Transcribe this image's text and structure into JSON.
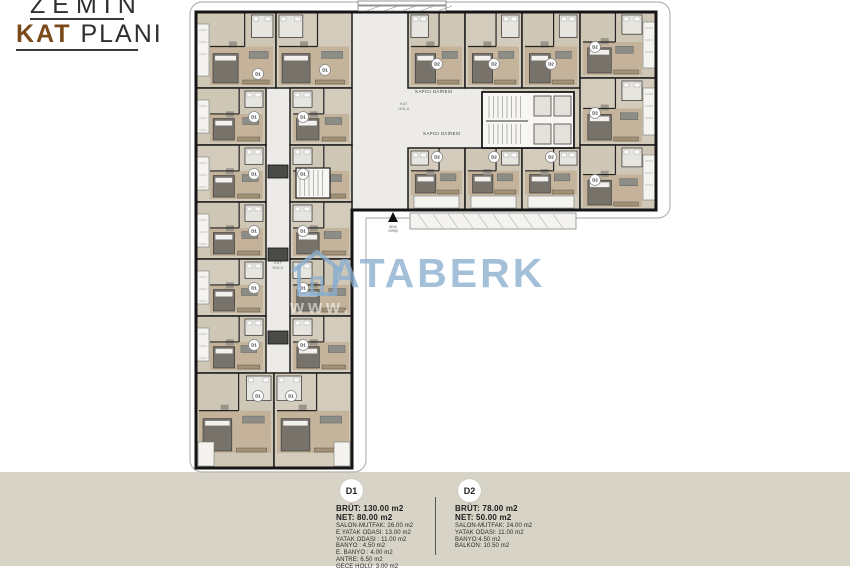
{
  "title": {
    "line1": "ZEMİN",
    "line2_accent": "KAT",
    "line2_rest": " PLANI",
    "accent_color": "#7a4a1a"
  },
  "watermark": {
    "text": "ATABERK",
    "ghost_text": "www.",
    "color": "#8aaece"
  },
  "plan": {
    "badge_labels": {
      "d1": "D1",
      "d2": "D2"
    },
    "labels": {
      "kapici_1": "KAPICI DAİRESİ",
      "kapici_2": "KAPICI DAİRESİ",
      "hall_line1": "KAT",
      "hall_line2": "HOLÜ",
      "corridor_line1": "KAT",
      "corridor_line2": "HOLÜ",
      "entrance_line1": "BİNA",
      "entrance_line2": "GİRİŞİ"
    }
  },
  "legend": {
    "items": [
      {
        "badge": "D1",
        "bold": [
          "BRÜT: 130.00 m2",
          "NET: 80.00 m2"
        ],
        "rows": [
          "SALON-MUTFAK: 26.00 m2",
          "E.YATAK ODASI: 13.00 m2",
          "YATAK ODASI : 11.00 m2",
          "BANYO : 4.50 m2",
          "E. BANYO : 4.00 m2",
          "ANTRE: 6.50 m2",
          "GECE HOLÜ: 3.00 m2"
        ]
      },
      {
        "badge": "D2",
        "bold": [
          "BRÜT: 78.00 m2",
          "NET: 50.00 m2"
        ],
        "rows": [
          "SALON-MUTFAK: 24.00 m2",
          "YATAK ODASI: 11.00 m2",
          "BANYO:4.50 m2",
          "BALKON: 10.50 m2"
        ]
      }
    ]
  },
  "colors": {
    "strip": "#d8d3c7",
    "wall": "#1c1c1c",
    "floor_a": "#d2cabb",
    "floor_b": "#cec6b5",
    "wood": "#c3b299",
    "hall": "#ecebe7",
    "watermark_blue": "#8aaece"
  }
}
